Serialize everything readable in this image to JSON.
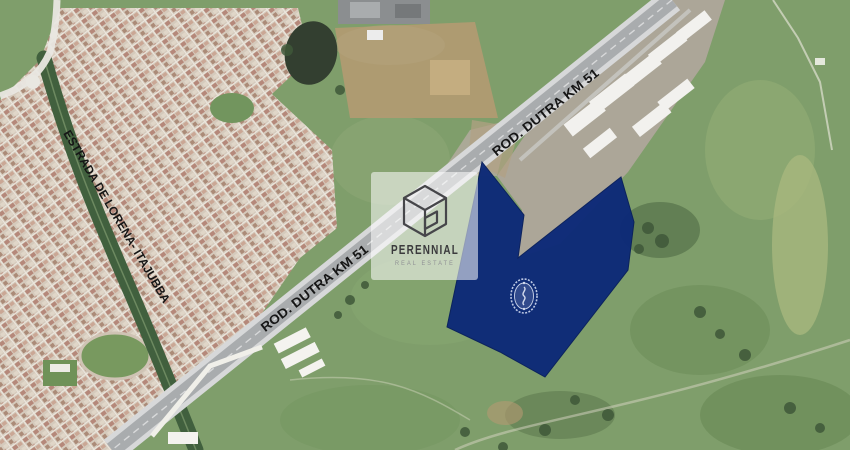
{
  "labels": {
    "highway_label_upper": "ROD. DUTRA KM 51",
    "highway_label_lower": "ROD. DUTRA KM 51",
    "road_label_left": "ESTRADA DE LORENA- ITAJUBBA"
  },
  "watermark": {
    "brand_name": "PERENNIAL",
    "brand_tagline": "REAL ESTATE",
    "logo_icon": "perennial-cube-logo-icon",
    "card_color": "rgba(255,255,255,0.55)"
  },
  "parcel": {
    "fill_color": "#0d2a78",
    "emblem_icon": "crest-badge-icon"
  },
  "map_colors": {
    "field_green": "#7f9e6b",
    "town_base": "#d5cabc",
    "highway_gray": "#a9acae",
    "pond_dark": "#333f30",
    "dirt_tan": "#b49a72"
  }
}
